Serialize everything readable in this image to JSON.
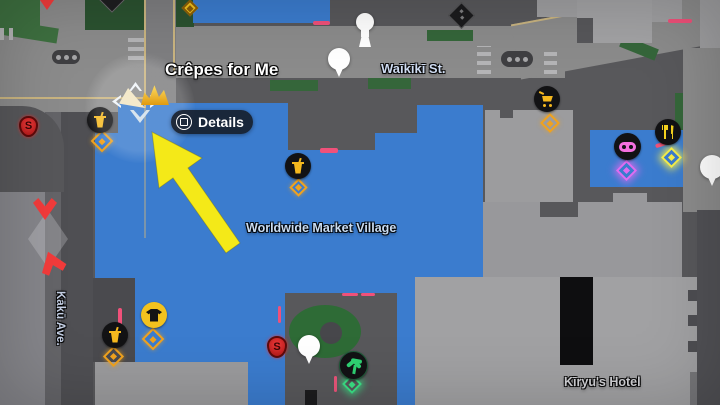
{
  "game_hud": {
    "shop_callout_label": "Crêpes for Me",
    "details_button": {
      "label": "Details",
      "button_glyph": "square"
    }
  },
  "map_labels": {
    "street_horizontal": "Waīkīkī St.",
    "street_vertical": "Kākū Ave.",
    "district_area": "Worldwide Market Village",
    "hotel": "Kīryu's Hotel"
  },
  "badges": {
    "s_shield_letter": "S"
  },
  "icons": {
    "drink_shop": "beverage-cup",
    "clothing_shop": "t-shirt",
    "store": "shopping-cart",
    "arcade": "game-controller",
    "restaurant": "fork-and-knife",
    "park": "palm-tree",
    "encounter": "s-shield",
    "collectible": "diamond-marker",
    "destination": "map-pin",
    "player": "player-arrow",
    "annotation": "yellow-highlight-arrow"
  },
  "colors": {
    "market_blue": "#3B7CCE",
    "highlight_arrow_yellow": "#F4E918",
    "icon_yellow": "#F5B81E",
    "arcade_pink": "#F570E0",
    "park_green": "#2FD273",
    "encounter_red": "#E02020",
    "road_gray": "#8B8B8B",
    "sidewalk_gray": "#57575A",
    "building_gray": "#9E9EA0",
    "label_blue_white": "#CFE0F2"
  }
}
